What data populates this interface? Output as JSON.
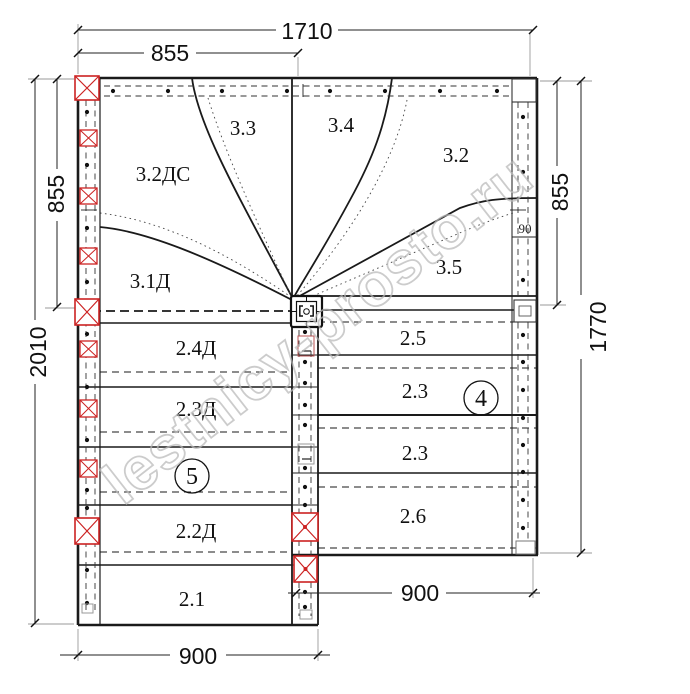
{
  "watermark": {
    "text": "lestnicy-prosto.ru"
  },
  "dimensions": {
    "top_total": "1710",
    "top_half": "855",
    "left_upper": "855",
    "left_total": "2010",
    "right_upper": "855",
    "right_total": "1770",
    "bottom_left": "900",
    "bottom_right": "900",
    "gap": "90"
  },
  "winder": {
    "s33": "3.3",
    "s34": "3.4",
    "s32ds": "3.2ДС",
    "s32": "3.2",
    "s31d": "3.1Д",
    "s35": "3.5"
  },
  "left_flight": {
    "s24": "2.4Д",
    "s23": "2.3Д",
    "s22": "2.2Д",
    "s21": "2.1",
    "marker": "5"
  },
  "right_flight": {
    "s25": "2.5",
    "s23a": "2.3",
    "s23b": "2.3",
    "s26": "2.6",
    "marker": "4"
  }
}
